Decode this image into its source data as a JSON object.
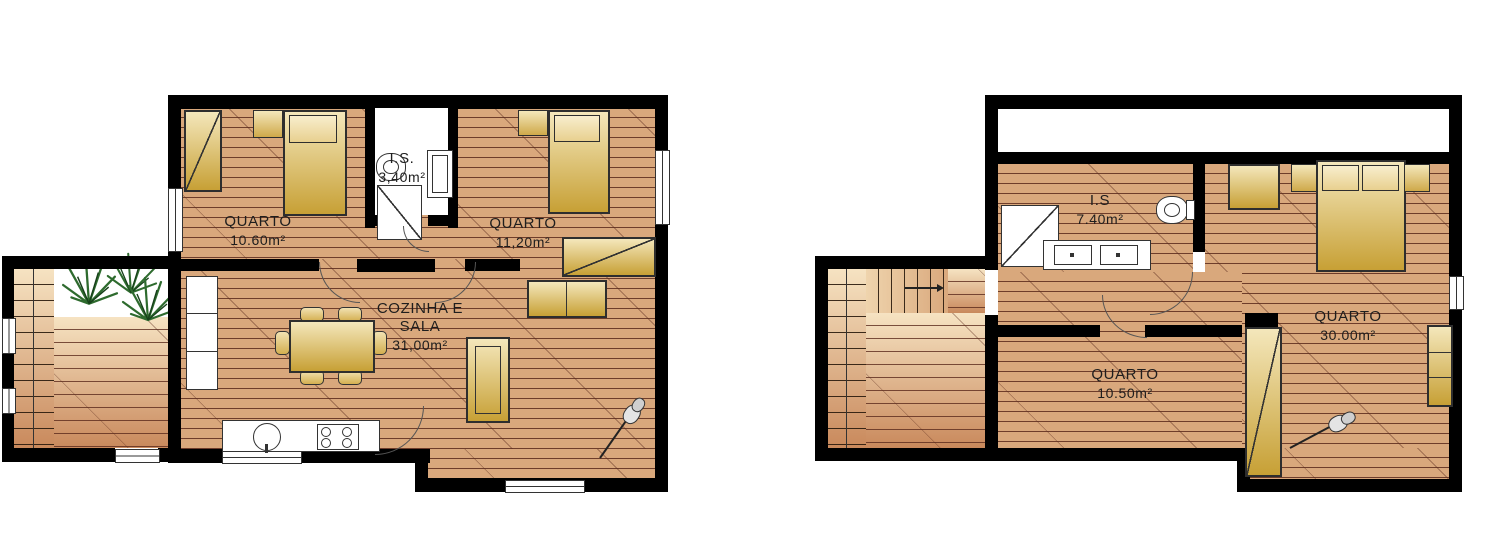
{
  "document": {
    "type": "architectural-floor-plan",
    "background": "#ffffff"
  },
  "plans": [
    {
      "name": "ground-floor-plan",
      "rooms": [
        {
          "line1": "QUARTO",
          "line2": "10.60m²"
        },
        {
          "line1": "I.S.",
          "line2": "3,40m²"
        },
        {
          "line1": "QUARTO",
          "line2": "11,20m²"
        },
        {
          "line1": "COZINHA E",
          "line2": "SALA",
          "line3": "31,00m²"
        }
      ],
      "symbols": [
        "single-bed",
        "nightstand",
        "wardrobe",
        "toilet",
        "shower",
        "bathroom-cabinet",
        "dining-table",
        "chairs",
        "sofa",
        "tv-bench",
        "sideboard",
        "kitchen-counter",
        "sink",
        "stove",
        "staircase",
        "palm-plants",
        "guitar",
        "windows",
        "doors"
      ]
    },
    {
      "name": "upper-floor-plan",
      "rooms": [
        {
          "line1": "I.S",
          "line2": "7.40m²"
        },
        {
          "line1": "QUARTO",
          "line2": "30.00m²"
        },
        {
          "line1": "QUARTO",
          "line2": "10.50m²"
        }
      ],
      "symbols": [
        "double-bed",
        "nightstands",
        "wardrobe",
        "tall-wardrobe",
        "toilet",
        "shower",
        "vanity-double-sink",
        "sofa",
        "staircase",
        "guitar",
        "window",
        "doors"
      ]
    }
  ],
  "colors": {
    "wall": "#000000",
    "floor_tan": "#d9a87c",
    "plank_line": "#5b2a1c",
    "furniture_gold_light": "#f4e7bb",
    "furniture_gold_dark": "#c7a035",
    "deck_light": "#f6e3c2",
    "deck_dark": "#c9895c",
    "plant_green": "#2e6b2e",
    "outline": "#333333",
    "background": "#ffffff"
  }
}
